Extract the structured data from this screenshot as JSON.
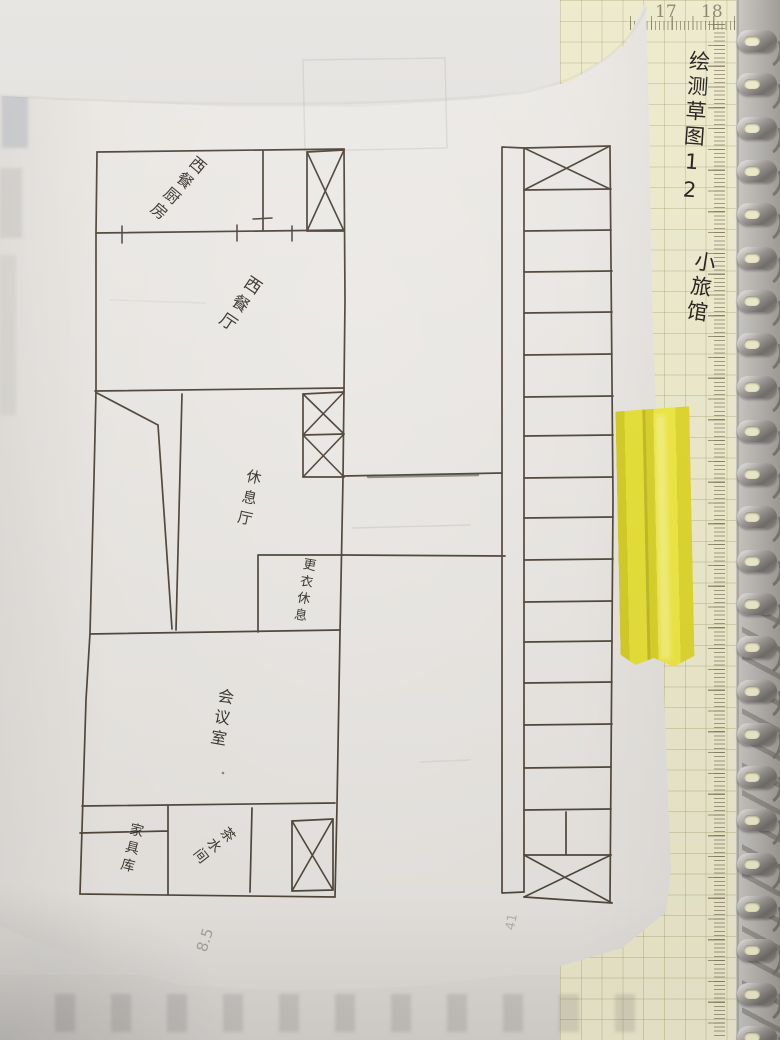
{
  "annotation": {
    "line1": "绘测草图12",
    "line2": "小旅馆"
  },
  "notebook": {
    "top_scale_numbers": [
      "17",
      "18"
    ],
    "side_scale_numbers": [
      "0",
      "1",
      "2",
      "3",
      "4",
      "5",
      "6",
      "7",
      "8",
      "9",
      "10",
      "11",
      "12",
      "13",
      "14",
      "15",
      "16",
      "17",
      "18",
      "19",
      "20",
      "21",
      "22",
      "23",
      "24"
    ],
    "coil_count": 24,
    "page_color": "#edeacd",
    "grid_color": "#d9d2ae"
  },
  "floor_plan": {
    "ink_color": "#463b2f",
    "rooms": {
      "kitchen": "西餐厨房",
      "dining_hall": "西餐厅",
      "lounge": "休息厅",
      "dressing_rest": "更衣休息",
      "meeting_room": "会议室",
      "furniture_store": "家具库",
      "tea_room": "茶水间"
    },
    "pencil_notes": {
      "note_bottom": "8.5",
      "note_right": "41"
    }
  },
  "tape": {
    "color": "#e6df2e"
  }
}
